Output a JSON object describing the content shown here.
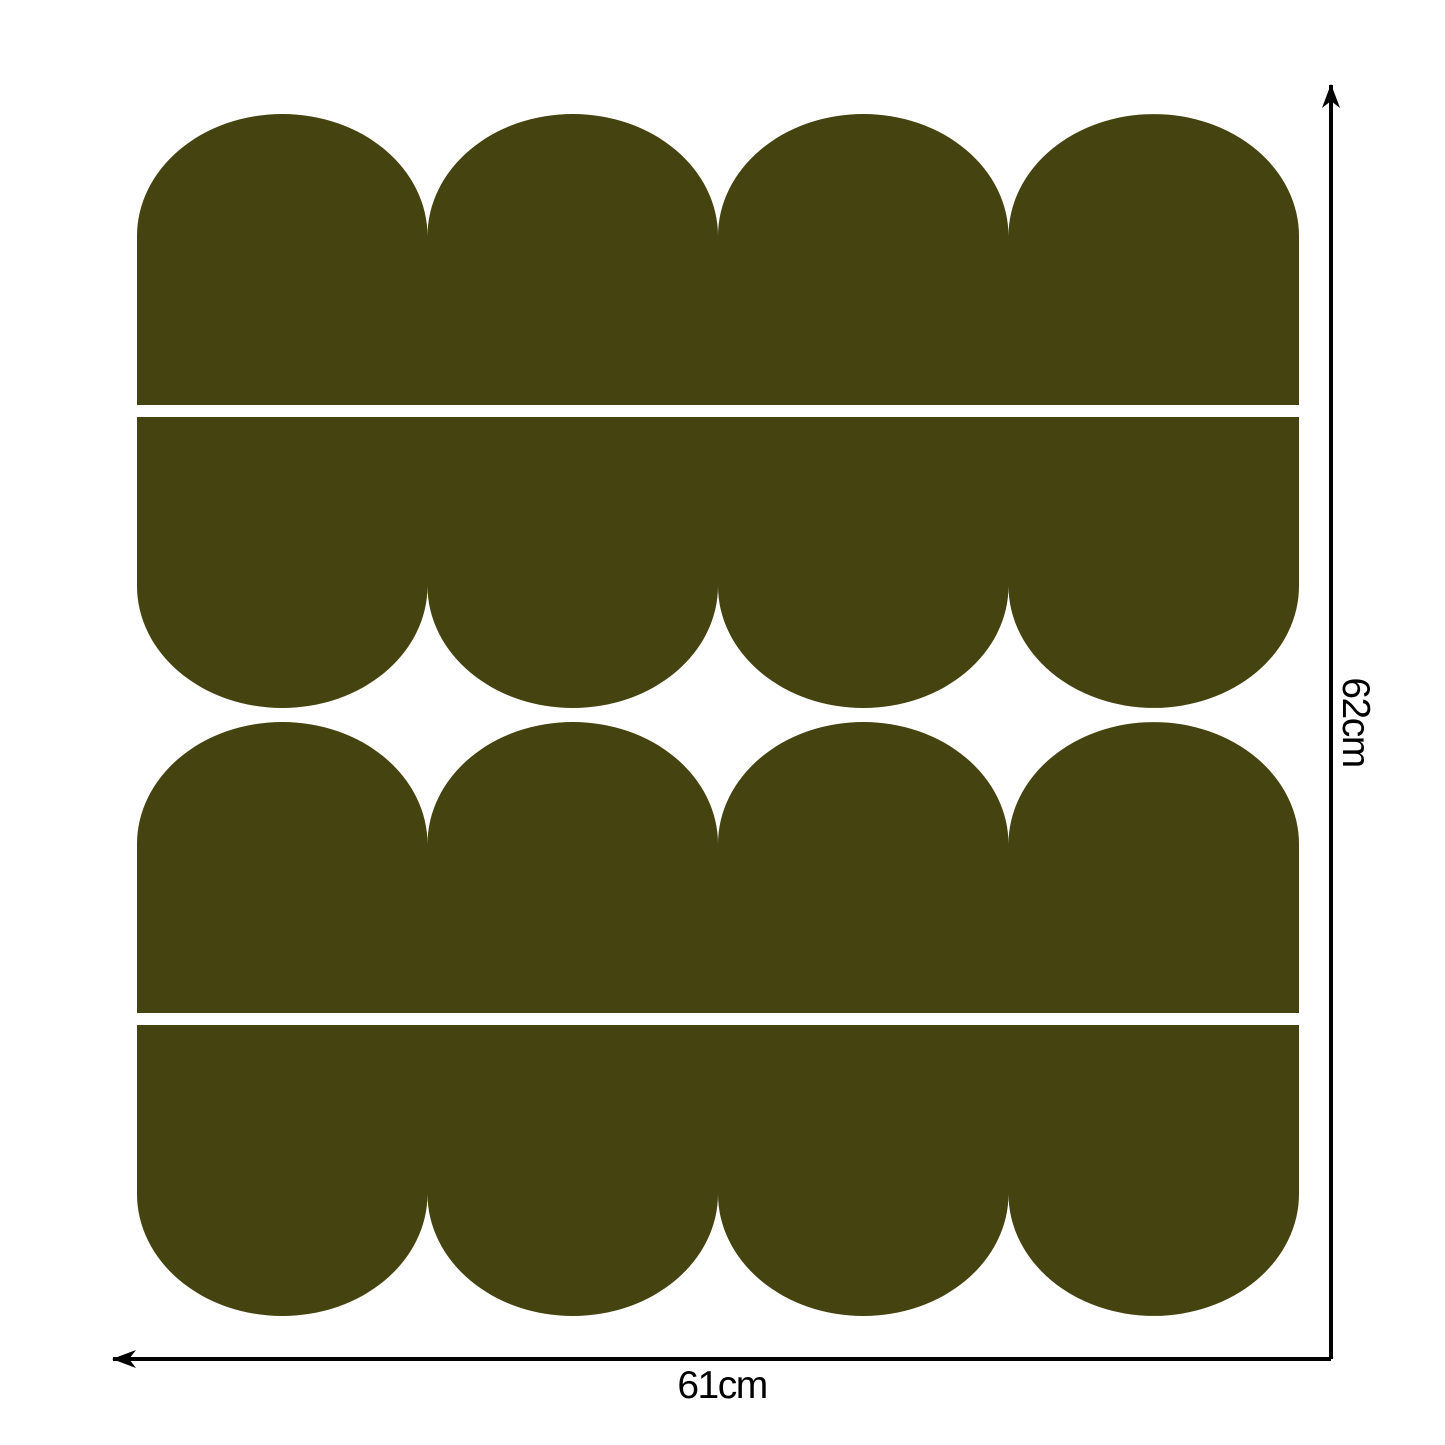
{
  "diagram": {
    "width_label": "61cm",
    "height_label": "62cm",
    "rows": [
      {
        "scallop_edge": "top",
        "scallops": 4
      },
      {
        "scallop_edge": "bottom",
        "scallops": 4
      },
      {
        "scallop_edge": "top",
        "scallops": 4
      },
      {
        "scallop_edge": "bottom",
        "scallops": 4
      }
    ],
    "colors": {
      "shape": "#45430f",
      "dimension_line": "#000000",
      "background": "#ffffff"
    }
  }
}
